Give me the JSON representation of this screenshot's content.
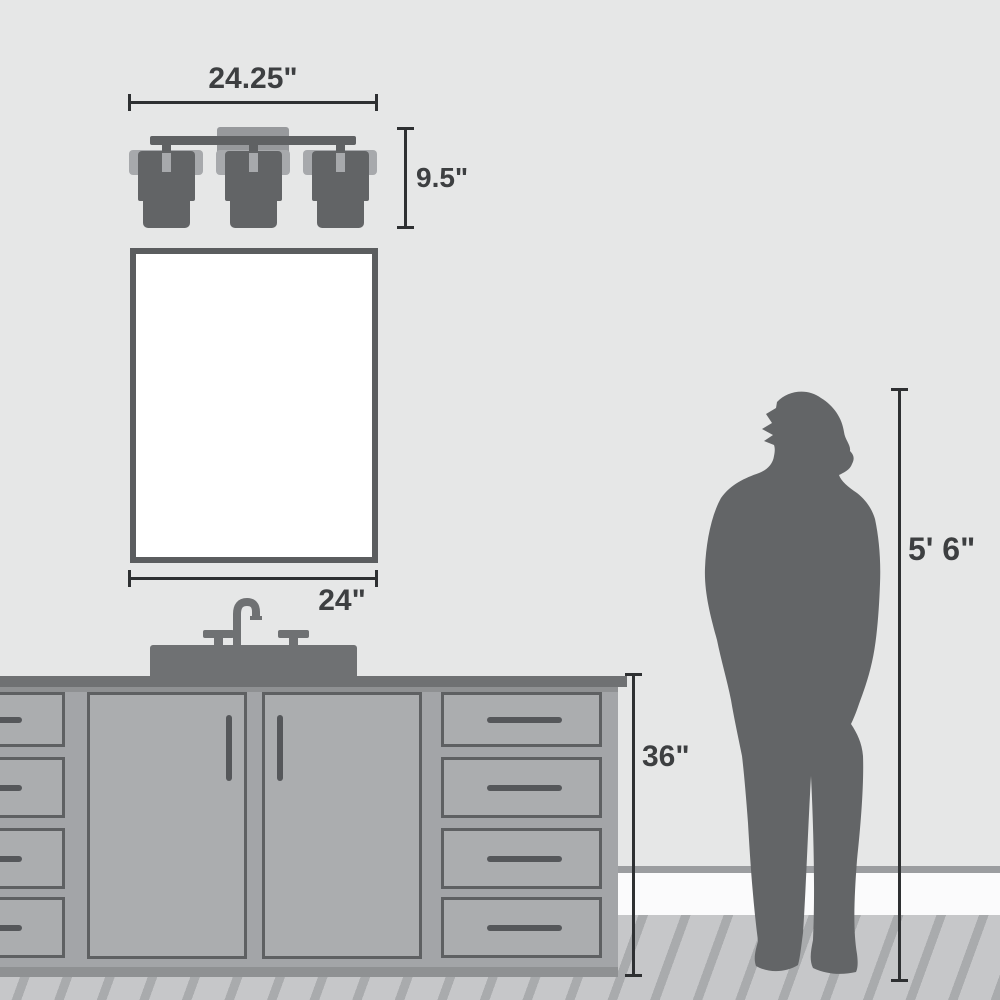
{
  "diagram": {
    "title": "Bathroom vanity light size-comparison diagram",
    "dimensions": {
      "fixture_width": "24.25\"",
      "fixture_height": "9.5\"",
      "mirror_width": "24\"",
      "vanity_height": "36\"",
      "person_height": "5' 6\""
    },
    "objects": [
      "three-light-vanity-fixture",
      "mirror",
      "faucet",
      "sink-deck",
      "countertop",
      "vanity-cabinet-with-doors-and-drawers",
      "person-silhouette",
      "baseboard",
      "plank-floor"
    ],
    "colors": {
      "wall": "#e6e7e7",
      "dimension_line": "#2e3032",
      "dimension_text": "#3d3f41",
      "fixture_dark": "#626466",
      "fixture_light": "#a7a9ac",
      "mirror_frame": "#5b5d5f",
      "mirror_fill": "#ffffff",
      "counter": "#6f7173",
      "cabinet": "#a8aaad",
      "panel_border": "#5e6062",
      "baseboard": "#fbfbfc",
      "floor_base": "#c6c7c9",
      "floor_stripe": "#a9abad",
      "silhouette": "#636567"
    }
  }
}
